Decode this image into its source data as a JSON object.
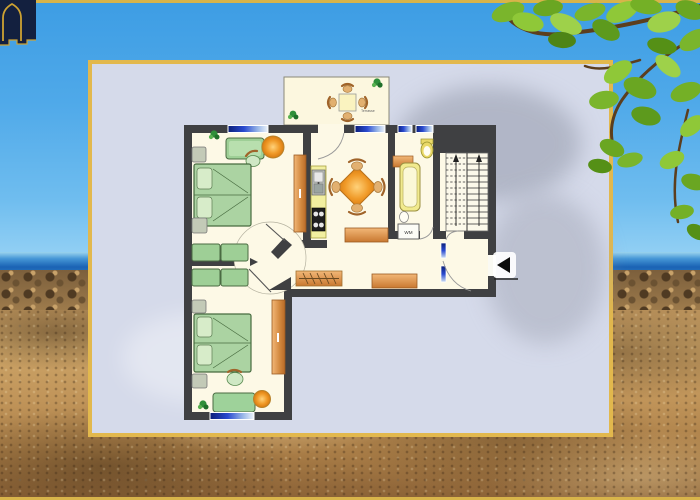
{
  "floor_plan": {
    "labels": {
      "terrace": "Terrasse",
      "washing_machine": "WM"
    },
    "entrance": {
      "arrow_direction": "left"
    },
    "colors": {
      "wall": "#3f4042",
      "floor": "#fdf9e6",
      "terrace_floor": "#fcf7df",
      "bed_green": "#abd3a2",
      "sofa_green": "#9ecf96",
      "wood_orange": "#d2883e",
      "counter_yellow": "#f2efa0",
      "window_blue": "#2a4ad0",
      "table_orange": "#f09a28",
      "chair_tan": "#e2b070",
      "fixture_yellow": "#ead969"
    }
  },
  "panel": {
    "border_color": "#e2b84d",
    "background_color": "#d5daea"
  },
  "scene": {
    "sky_color": "#4fa9e9",
    "sea_color": "#1b63b4",
    "sand_color": "#c09459",
    "frame_line_color": "#d8b44a",
    "logo": {
      "background_color": "#13203f",
      "outline_color": "#cda232"
    },
    "foliage": {
      "leaf_color": "#7ab52c",
      "branch_color": "#5c3e1e"
    }
  }
}
